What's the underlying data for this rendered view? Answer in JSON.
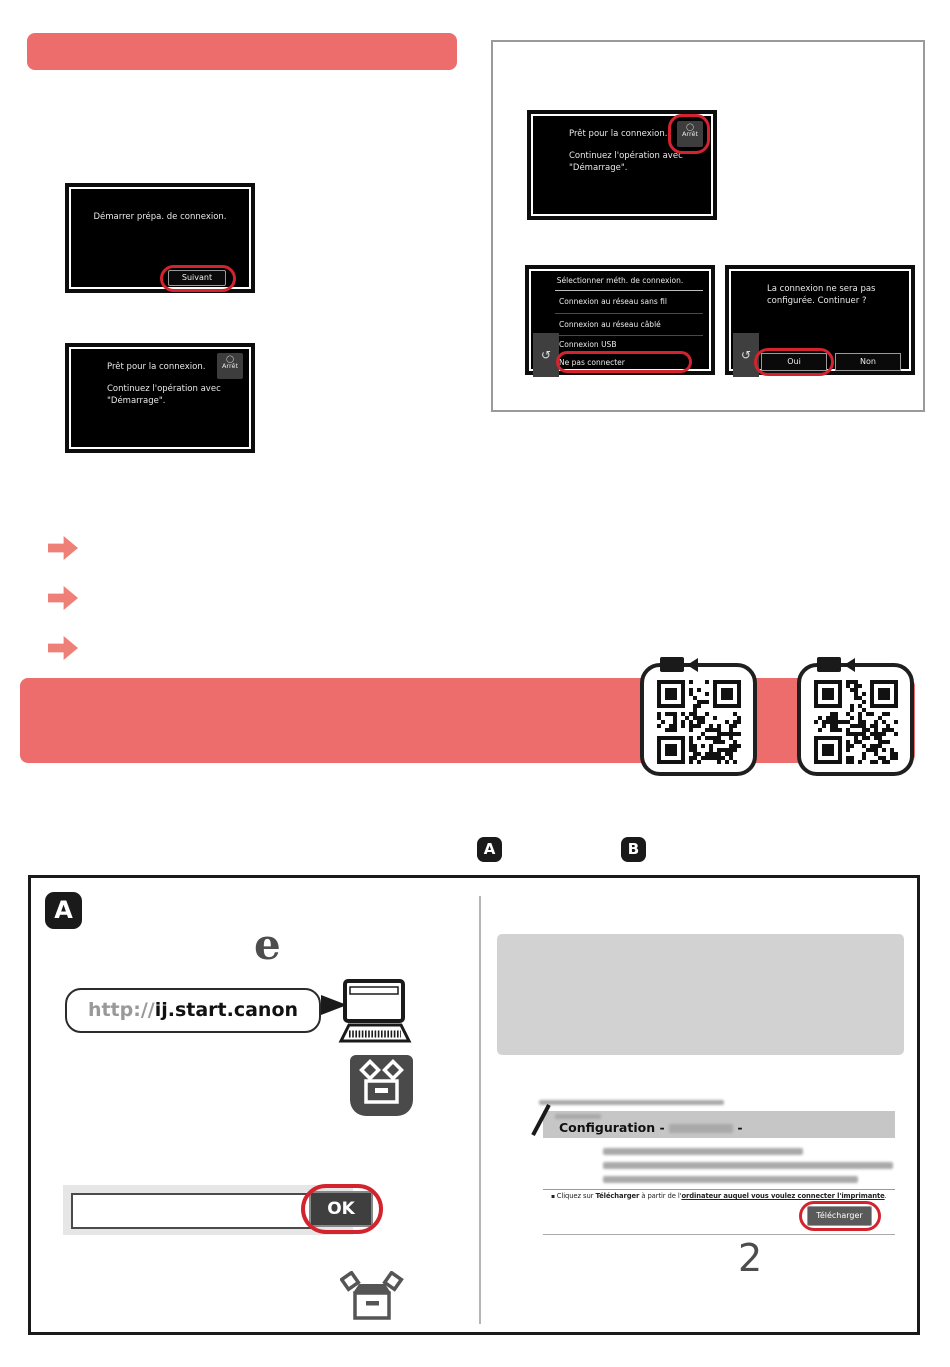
{
  "lcd": {
    "start_prep": {
      "message": "Démarrer prépa. de connexion.",
      "next_button": "Suivant"
    },
    "ready": {
      "line1": "Prêt pour la connexion.",
      "line2": "Continuez l'opération avec",
      "line3": "\"Démarrage\".",
      "stop_button": "Arrêt"
    },
    "select_method": {
      "title": "Sélectionner méth. de connexion.",
      "options": [
        "Connexion au réseau sans fil",
        "Connexion au réseau câblé",
        "Connexion USB",
        "Ne pas connecter"
      ]
    },
    "confirm": {
      "line1": "La connexion ne sera pas",
      "line2": "configurée. Continuer ?",
      "yes_button": "Oui",
      "no_button": "Non"
    }
  },
  "section_labels": {
    "a": "A",
    "b": "B"
  },
  "browser_box": {
    "url_prefix": "http://",
    "url_domain": "ij.start.canon",
    "ok_button": "OK",
    "step_number": "2"
  },
  "config_page": {
    "title": "Configuration -",
    "title_suffix": "-",
    "instruction": {
      "pre": "Cliquez sur ",
      "bold": "Télécharger",
      "mid": " à partir de l'",
      "link": "ordinateur auquel vous voulez connecter l'imprimante",
      "end": "."
    },
    "download_button": "Télécharger"
  },
  "icons": {
    "back": "↺",
    "edge": "e",
    "stop": "◯"
  },
  "colors": {
    "accent_pink": "#ed6c6c",
    "highlight_red": "#d2232e"
  }
}
